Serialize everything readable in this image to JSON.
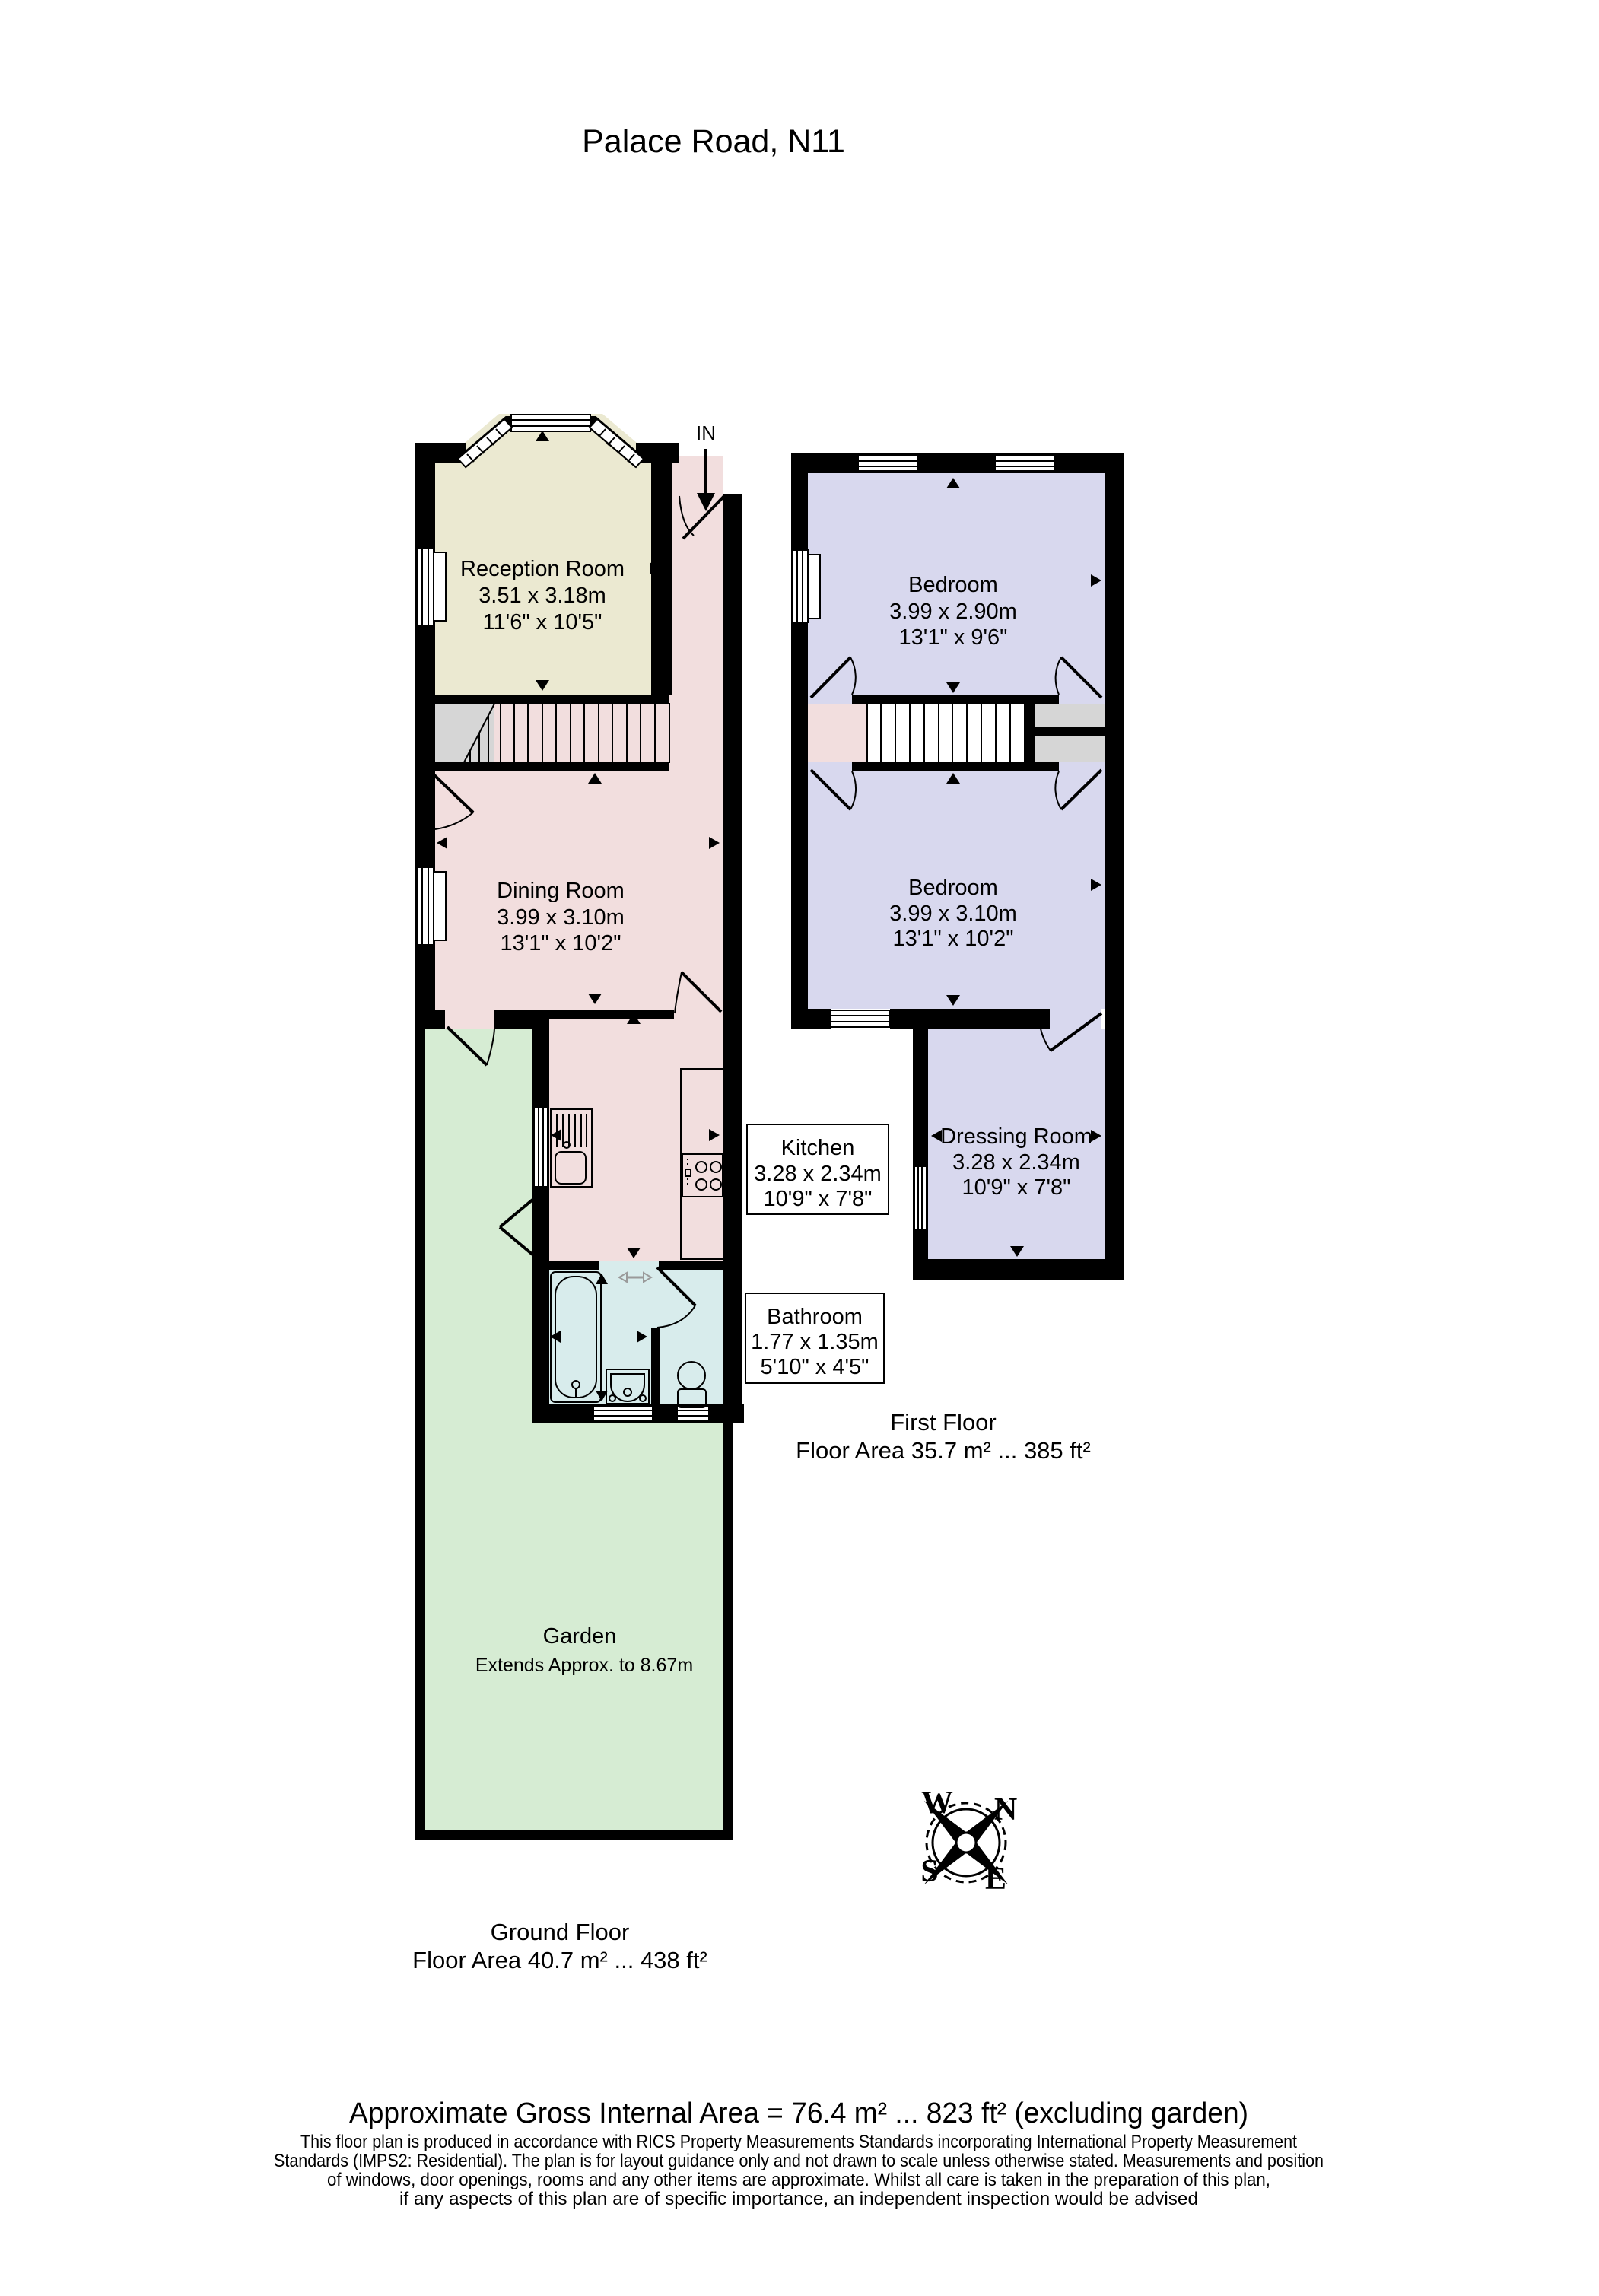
{
  "title": "Palace Road, N11",
  "entrance_label": "IN",
  "ground_floor": {
    "label": "Ground Floor",
    "area_line": "Floor Area 40.7 m² ... 438 ft²",
    "reception": {
      "name": "Reception Room",
      "metric": "3.51 x 3.18m",
      "imperial": "11'6\" x 10'5\""
    },
    "dining": {
      "name": "Dining Room",
      "metric": "3.99 x 3.10m",
      "imperial": "13'1\" x 10'2\""
    },
    "kitchen": {
      "name": "Kitchen",
      "metric": "3.28 x 2.34m",
      "imperial": "10'9\" x 7'8\""
    },
    "bathroom": {
      "name": "Bathroom",
      "metric": "1.77 x 1.35m",
      "imperial": "5'10\" x 4'5\""
    },
    "garden": {
      "name": "Garden",
      "note": "Extends Approx. to 8.67m"
    }
  },
  "first_floor": {
    "label": "First Floor",
    "area_line": "Floor Area 35.7 m² ... 385 ft²",
    "bedroom_front": {
      "name": "Bedroom",
      "metric": "3.99 x 2.90m",
      "imperial": "13'1\" x 9'6\""
    },
    "bedroom_back": {
      "name": "Bedroom",
      "metric": "3.99 x 3.10m",
      "imperial": "13'1\" x 10'2\""
    },
    "dressing": {
      "name": "Dressing Room",
      "metric": "3.28 x 2.34m",
      "imperial": "10'9\" x 7'8\""
    }
  },
  "compass": {
    "north": "N",
    "east": "E",
    "south": "S",
    "west": "W"
  },
  "footer": {
    "gross_area": "Approximate Gross Internal Area = 76.4 m² ... 823 ft² (excluding garden)",
    "disclaimer": [
      "This floor plan is produced in accordance with RICS Property Measurements Standards incorporating International Property Measurement",
      "Standards (IMPS2: Residential). The plan is for layout guidance only and not drawn to scale unless otherwise stated. Measurements and position",
      "of windows, door openings, rooms and any other items are approximate. Whilst all care is taken in the preparation of this plan,",
      "if any aspects of this plan are of specific importance, an independent inspection would be advised"
    ]
  },
  "colors": {
    "wall": "#000000",
    "reception_cream": "#ebe9d1",
    "hall_pink": "#f2dede",
    "bedroom_lavender": "#d8d8ee",
    "bathroom_blue": "#d8ecec",
    "garden_green": "#d6ecd3",
    "cupboard_grey": "#d6d6d6"
  }
}
